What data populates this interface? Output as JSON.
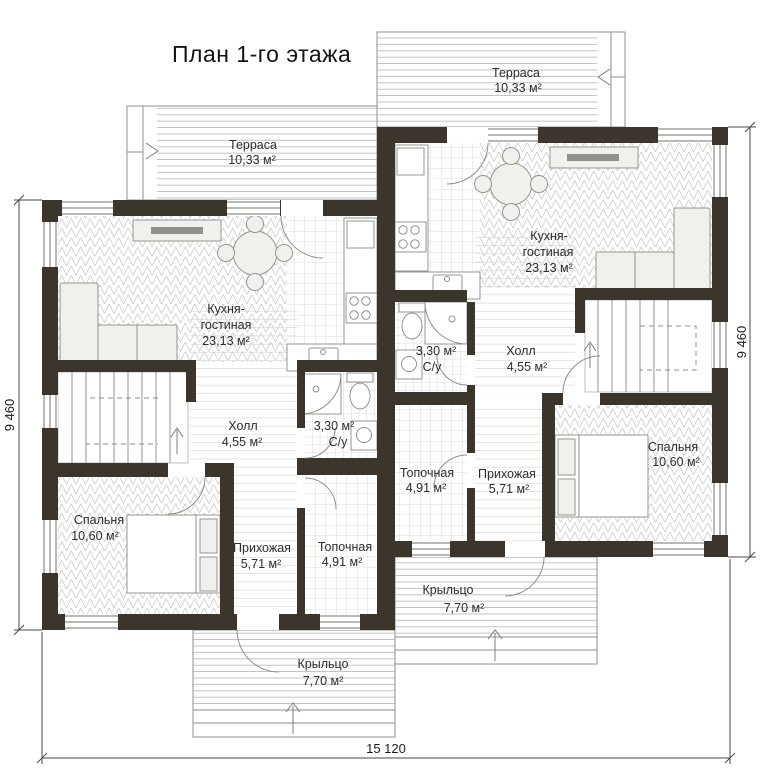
{
  "title": "План 1-го этажа",
  "dimensions": {
    "bottom": "15 120",
    "left": "9 460",
    "right": "9 460"
  },
  "colors": {
    "wall": "#3b352b",
    "floor_lines": "#c9c9c6",
    "text": "#2d2d2b"
  },
  "rooms": {
    "terrace_left": {
      "name": "Терраса",
      "area": "10,33 м²"
    },
    "terrace_right": {
      "name": "Терраса",
      "area": "10,33 м²"
    },
    "kitchen_left": {
      "name1": "Кухня-",
      "name2": "гостиная",
      "area": "23,13 м²"
    },
    "kitchen_right": {
      "name1": "Кухня-",
      "name2": "гостиная",
      "area": "23,13 м²"
    },
    "hall_left": {
      "name": "Холл",
      "area": "4,55 м²"
    },
    "hall_right": {
      "name": "Холл",
      "area": "4,55 м²"
    },
    "wc_left": {
      "area": "3,30 м²",
      "name": "С/у"
    },
    "wc_right": {
      "area": "3,30 м²",
      "name": "С/у"
    },
    "bedroom_left": {
      "name": "Спальня",
      "area": "10,60 м²"
    },
    "bedroom_right": {
      "name": "Спальня",
      "area": "10,60 м²"
    },
    "entry_left": {
      "name": "Прихожая",
      "area": "5,71 м²"
    },
    "entry_right": {
      "name": "Прихожая",
      "area": "5,71 м²"
    },
    "boiler_left": {
      "name": "Топочная",
      "area": "4,91 м²"
    },
    "boiler_right": {
      "name": "Топочная",
      "area": "4,91 м²"
    },
    "porch_left": {
      "name": "Крыльцо",
      "area": "7,70 м²"
    },
    "porch_right": {
      "name": "Крыльцо",
      "area": "7,70 м²"
    }
  }
}
